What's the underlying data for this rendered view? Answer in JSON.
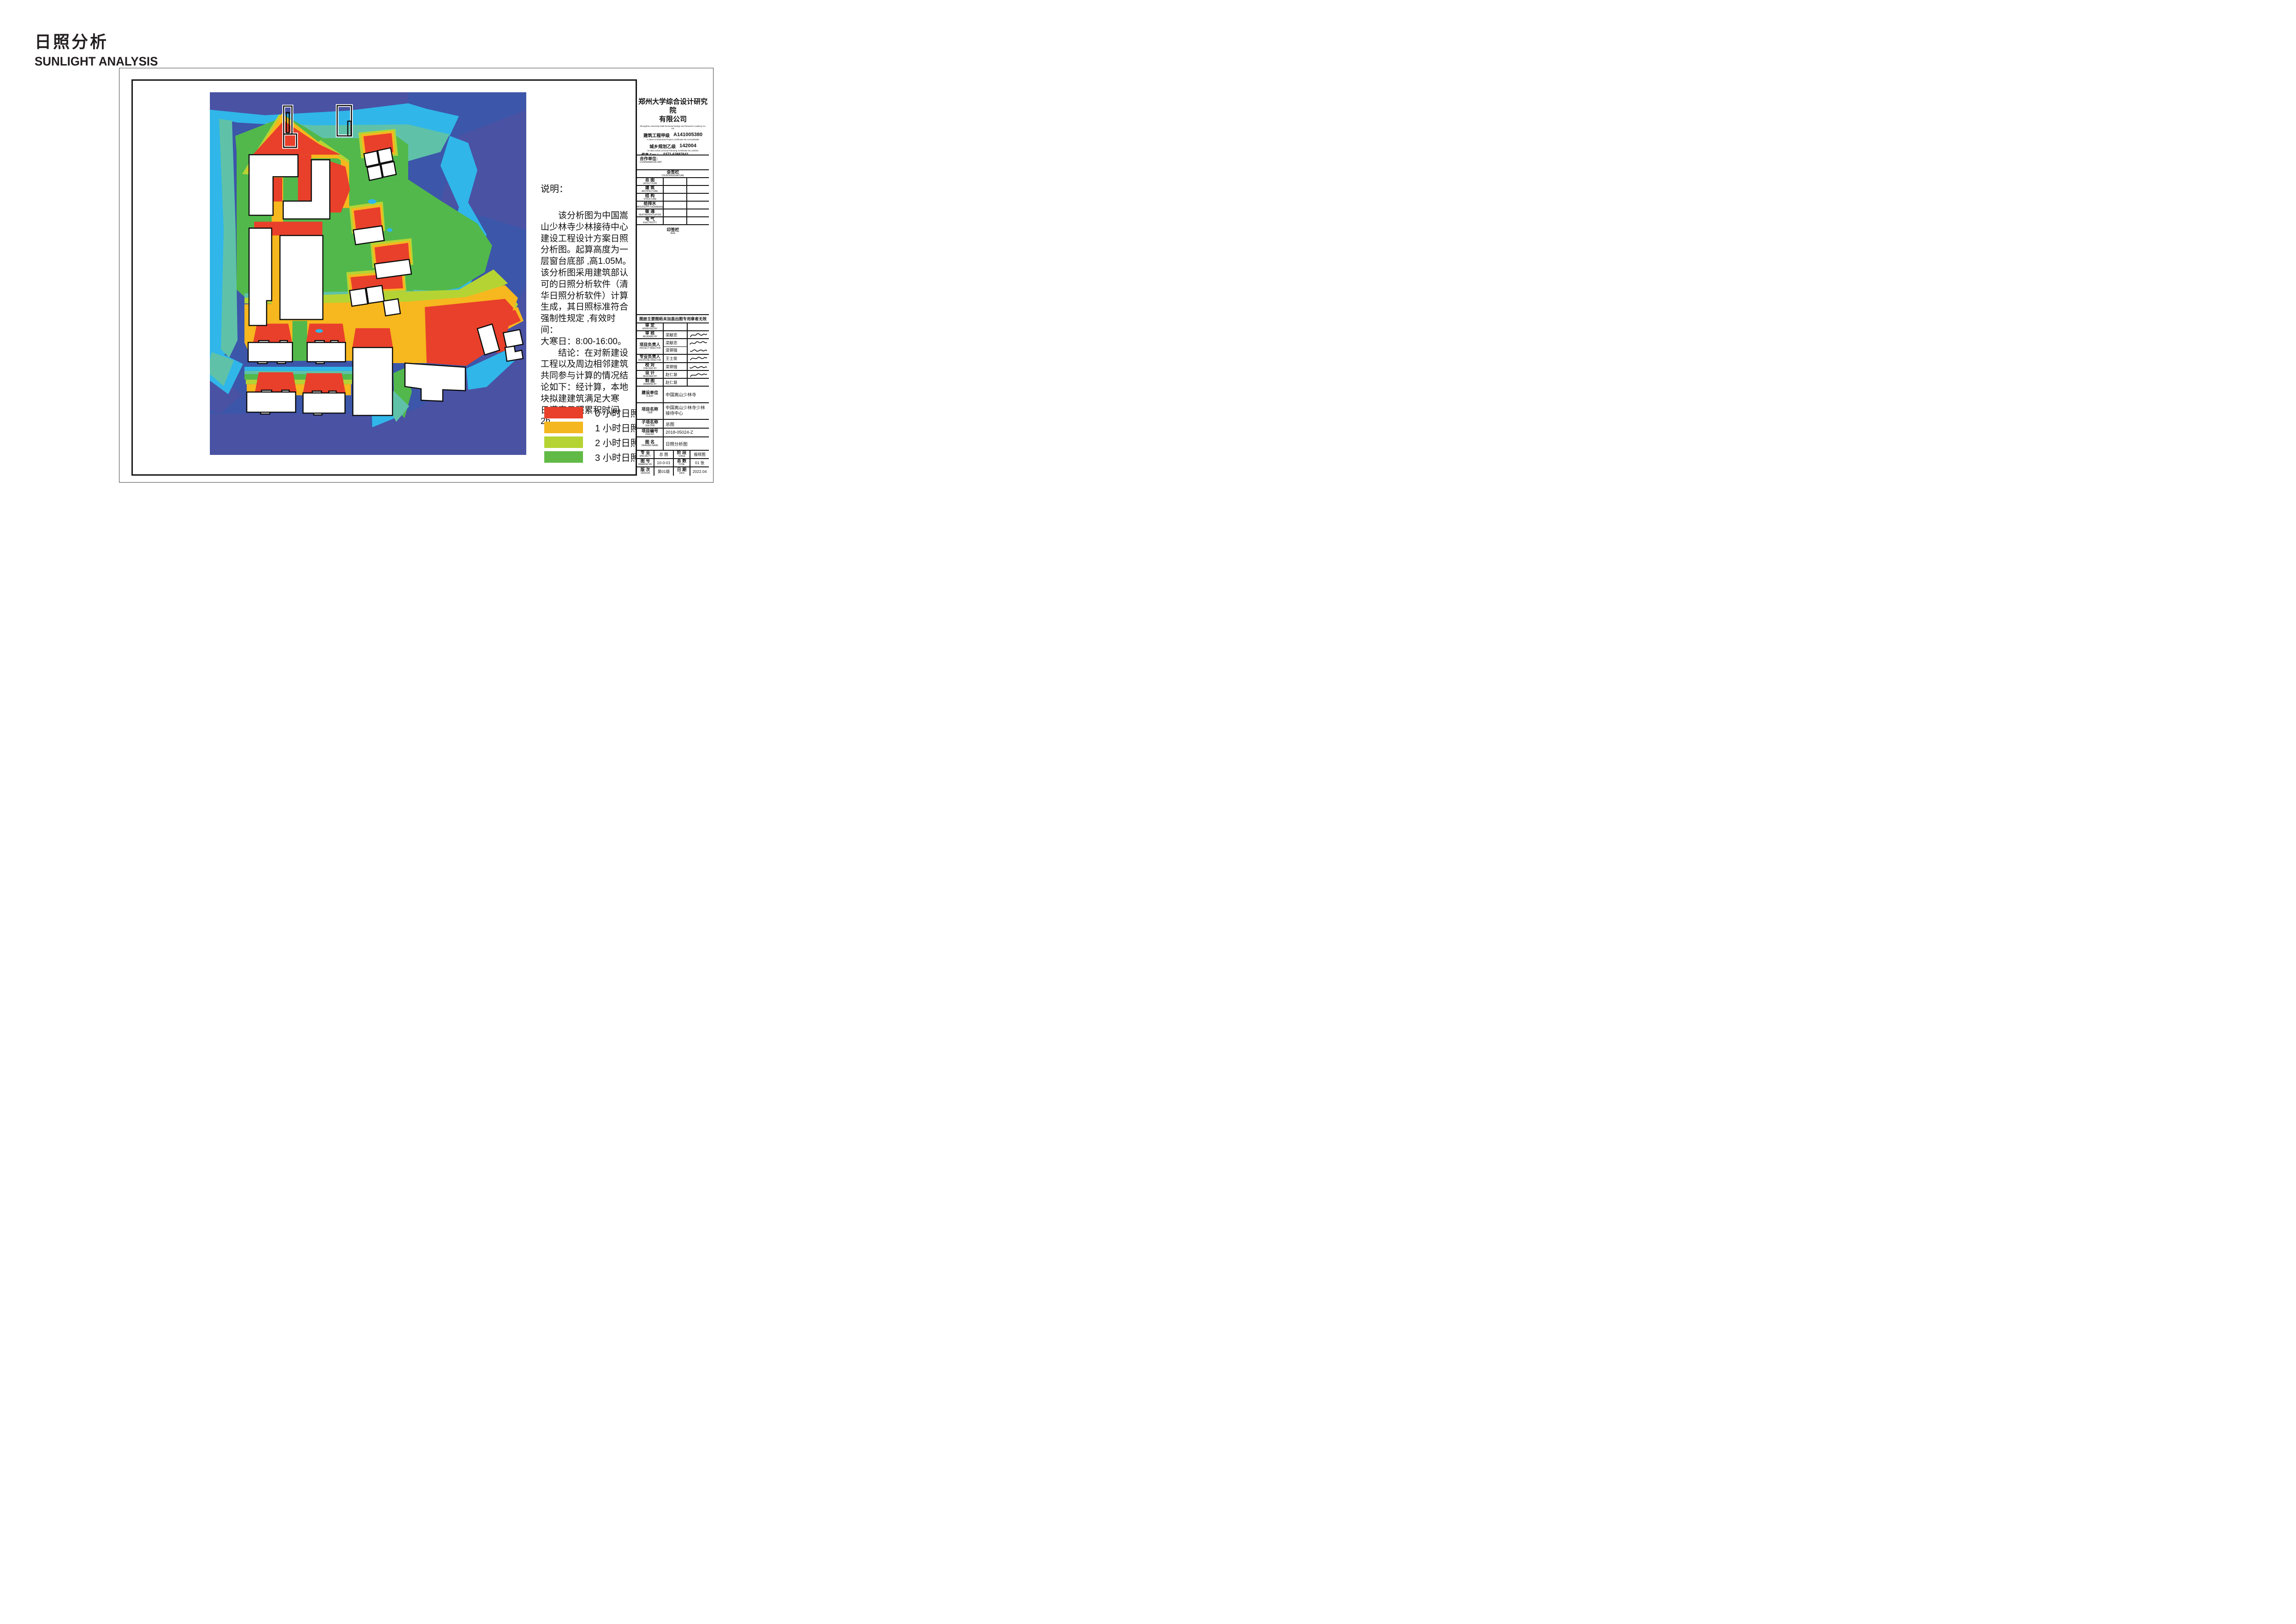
{
  "page_title": {
    "cn": "日照分析",
    "en": "SUNLIGHT ANALYSIS"
  },
  "notes": {
    "heading": "说明：",
    "body": "　　该分析图为中国嵩\n山少林寺少林接待中心\n建设工程设计方案日照\n分析图。起算高度为一\n层窗台底部 ,高1.05M。\n该分析图采用建筑部认\n可的日照分析软件（清\n华日照分析软件）计算\n生成，其日照标准符合\n强制性规定 ,有效时间：\n大寒日：8:00-16:00。\n　　结论：在对新建设\n工程以及周边相邻建筑\n共同参与计算的情况结\n论如下：经计算，本地\n块拟建建筑满足大寒\n日满窗日照累积时间\n2h。"
  },
  "legend": {
    "items": [
      {
        "label": "0 小时日照",
        "color": "#e8402b"
      },
      {
        "label": "1 小时日照",
        "color": "#f5b71f"
      },
      {
        "label": "2 小时日照",
        "color": "#b5d434"
      },
      {
        "label": "3 小时日照",
        "color": "#61ba46"
      }
    ]
  },
  "map_colors": {
    "royal_blue": "#3c56a9",
    "violet_blue": "#4a52a4",
    "cyan": "#30b6e9",
    "teal": "#5fc2a8",
    "green": "#52b84b",
    "yellow_green": "#b5d434",
    "orange": "#f7b71e",
    "red": "#e8402b"
  },
  "title_block": {
    "company": {
      "name_line1": "郑州大学综合设计研究院",
      "name_line2": "有限公司",
      "name_en": "ZhengZhou University Multi-functional Design and Research Academy Co. Ltd.",
      "cert1_cn": "建筑工程甲级",
      "cert1_no": "A141005380",
      "cert1_en": "A class Architectural Project Certificate No.A141005380",
      "cert2_cn": "城乡规划乙级",
      "cert2_no": "142004",
      "cert2_en": "B class Urban & Rural Planning Certificate No.142004",
      "fax_label": "传真 Fax ：",
      "fax": "0371-63887641",
      "url_label": "网址 URL ：",
      "url": "Http://www.zdsjy.com",
      "pc_label": "邮编 P.C.：",
      "pc": "450002",
      "add_label": "地址 ADD.：",
      "add": "河南省郑州市文化路97号",
      "add_en": "No.97 Wenhua Road,Zhengzhou City,Henan Prov."
    },
    "cooperation": {
      "cn": "合作单位:",
      "en": "COOPERRATION UNIT"
    },
    "countersignature": {
      "cn": "会签栏",
      "en": "COUNTERSIGNATURE",
      "rows": [
        {
          "cn": "总  图",
          "en": "LAYOUT PLAN"
        },
        {
          "cn": "建  筑",
          "en": "ARCHITECTURE"
        },
        {
          "cn": "结  构",
          "en": "STRUCTURE"
        },
        {
          "cn": "给排水",
          "en": "WATERSUPPLY&DRAINAGE"
        },
        {
          "cn": "暖  通",
          "en": "HEATINGVENTILATION"
        },
        {
          "cn": "电  气",
          "en": "ELECTRICITY"
        }
      ]
    },
    "seal": {
      "cn": "印签栏",
      "en": "SEAL"
    },
    "notice": "图册主要图纸未加盖出图专用章者无效",
    "approvals": [
      {
        "cn": "审  定",
        "en": "APPROVED BY",
        "name": ""
      },
      {
        "cn": "审  核",
        "en": "REVIEWED BY",
        "name": "梁献忠"
      },
      {
        "cn": "项目负责人",
        "en": "PROJECT DIRECTOR",
        "name1": "梁献忠",
        "name2": "梁钢强"
      },
      {
        "cn": "专业负责人",
        "en": "DISCIPLINE DIRECTOR",
        "name": "王士俊"
      },
      {
        "cn": "校  对",
        "en": "CHECKED BY",
        "name": "梁钢强"
      },
      {
        "cn": "设  计",
        "en": "DESIGNED BY",
        "name": "赵仁慧"
      },
      {
        "cn": "制  图",
        "en": "DRAWING BY",
        "name": "赵仁慧"
      }
    ],
    "project": [
      {
        "cn": "建设单位",
        "en": "CLIENT",
        "value": "中国嵩山少林寺"
      },
      {
        "cn": "项目名称",
        "en": "ITEM",
        "value": "中国嵩山少林寺少林\n接待中心"
      },
      {
        "cn": "子项名称",
        "en": "Sub-ITEM",
        "value": "总图"
      },
      {
        "cn": "项目编号",
        "en": "ITEM NO.",
        "value": "2018-05024-Z"
      },
      {
        "cn": "图    名",
        "en": "DRAWING NAME",
        "value": "日照分析图"
      }
    ],
    "footer": {
      "r1": {
        "l1cn": "专  业",
        "l1en": "SPECIALTY",
        "v1": "总 图",
        "l2cn": "阶  段",
        "l2en": "STAGE",
        "v2": "报规图"
      },
      "r2": {
        "l1cn": "图  号",
        "l1en": "DRAWING NO.",
        "v1": "10-0-01",
        "l2cn": "总  数",
        "l2en": "TOTAL",
        "v2": "01 张"
      },
      "r3": {
        "l1cn": "版  次",
        "l1en": "VERSION",
        "v1": "第01版",
        "l2cn": "日  期",
        "l2en": "DATE",
        "v2": "2022.04"
      }
    }
  }
}
